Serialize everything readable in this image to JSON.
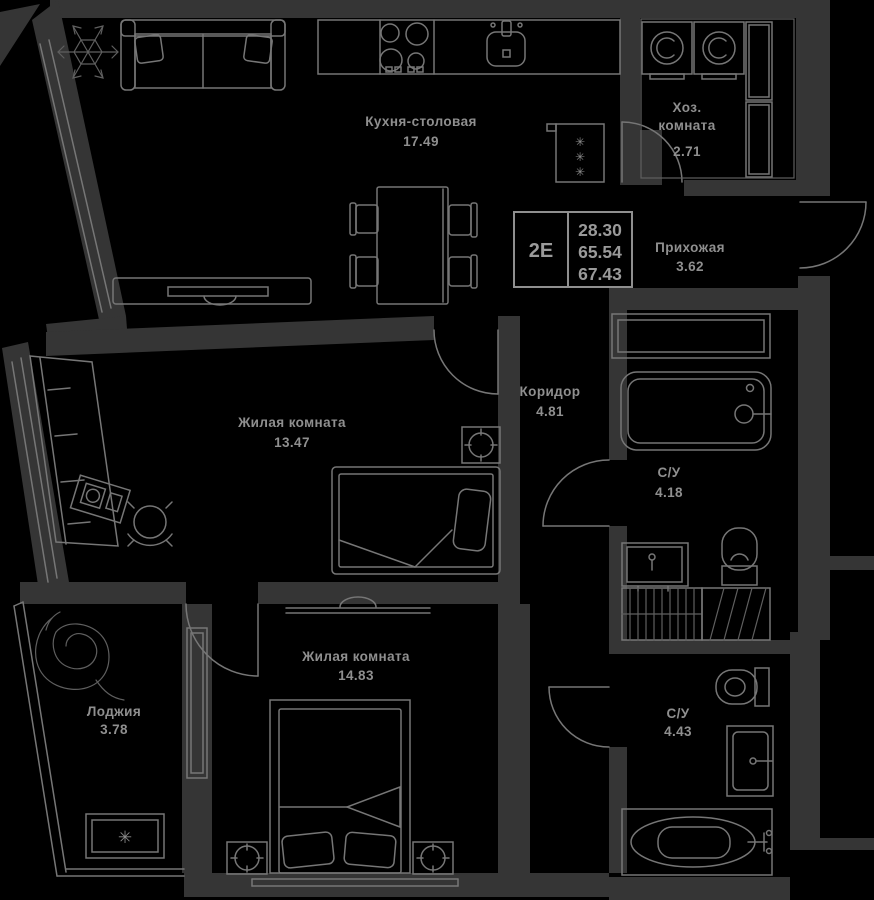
{
  "unit": {
    "type_label": "2Е",
    "area_living": "28.30",
    "area_main": "65.54",
    "area_total": "67.43"
  },
  "rooms": {
    "kitchen": {
      "name": "Кухня-столовая",
      "area": "17.49"
    },
    "utility": {
      "name_line1": "Хоз.",
      "name_line2": "комната",
      "area": "2.71"
    },
    "hallway": {
      "name": "Прихожая",
      "area": "3.62"
    },
    "corridor": {
      "name": "Коридор",
      "area": "4.81"
    },
    "living_room_1": {
      "name": "Жилая комната",
      "area": "13.47"
    },
    "living_room_2": {
      "name": "Жилая комната",
      "area": "14.83"
    },
    "loggia": {
      "name": "Лоджия",
      "area": "3.78"
    },
    "bathroom_1": {
      "name": "С/У",
      "area": "4.18"
    },
    "bathroom_2": {
      "name": "С/У",
      "area": "4.43"
    }
  },
  "glyphs": {
    "snowflake": "✳"
  },
  "colors": {
    "background": "#000000",
    "wall_fill": "#353535",
    "line": "#767676",
    "text": "#8f8f8f"
  },
  "fixtures": [
    "sofa",
    "snowflake-decor",
    "stove",
    "kitchen-sink",
    "fridge",
    "dining-table",
    "dining-chair",
    "tv-console",
    "wardrobe",
    "desk",
    "office-chair",
    "single-bed",
    "nightstand-lamp",
    "double-bed",
    "ceiling-light",
    "bathtub",
    "washbasin",
    "toilet",
    "washing-machine",
    "storage-cabinet",
    "shower-shelf",
    "vent-shaft",
    "plant-decor",
    "ac-unit",
    "entry-door",
    "interior-door",
    "window"
  ]
}
